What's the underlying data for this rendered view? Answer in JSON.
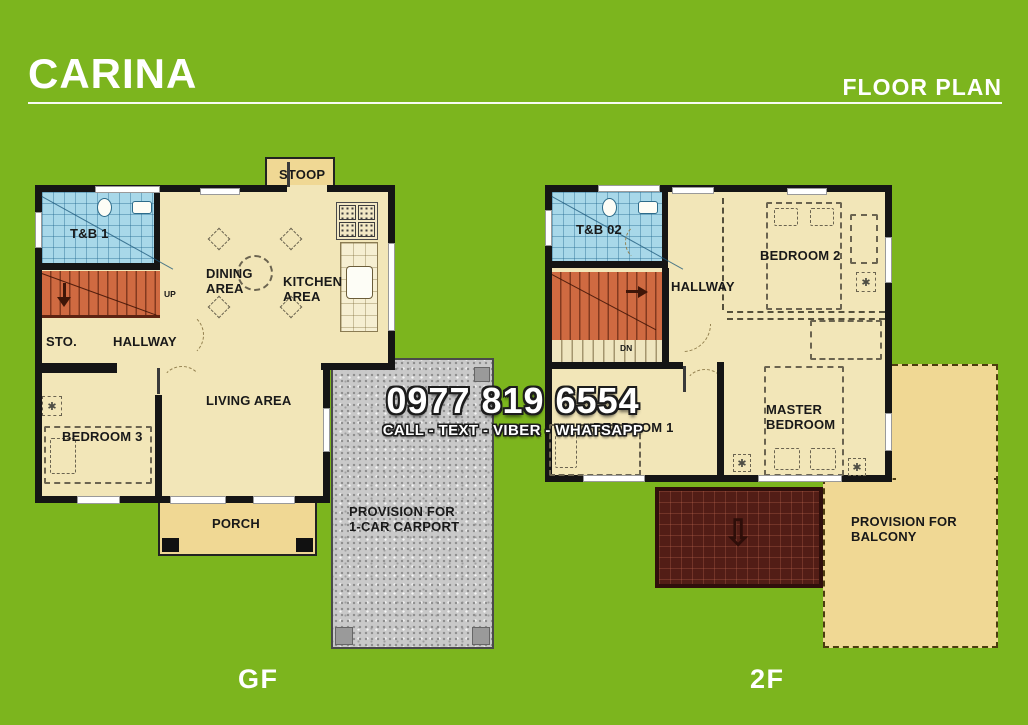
{
  "header": {
    "title": "CARINA",
    "right_title": "FLOOR PLAN"
  },
  "overlay": {
    "phone": "0977 819 6554",
    "channels": "CALL - TEXT - VIBER - WHATSAPP"
  },
  "ground_floor": {
    "floor_label": "GF",
    "rooms": {
      "stoop": "STOOP",
      "toilet_bath": "T&B 1",
      "dining": "DINING\nAREA",
      "kitchen": "KITCHEN\nAREA",
      "storage": "STO.",
      "hallway": "HALLWAY",
      "living": "LIVING AREA",
      "bedroom3": "BEDROOM 3",
      "porch": "PORCH",
      "carport": "PROVISION FOR\n1-CAR CARPORT",
      "stairs_up": "UP"
    }
  },
  "second_floor": {
    "floor_label": "2F",
    "rooms": {
      "toilet_bath": "T&B 02",
      "hallway": "HALLWAY",
      "bedroom2": "BEDROOM 2",
      "bedroom1": "BEDROOM 1",
      "master": "MASTER\nBEDROOM",
      "balcony": "PROVISION FOR\nBALCONY",
      "stairs_down": "DN"
    }
  },
  "colors": {
    "background": "#7CB51E",
    "floor": "#F2E6B8",
    "accent_cream": "#F0D894",
    "bath_blue": "#A8D8E9",
    "stair_orange": "#CF6A41",
    "roof_maroon": "#521D16",
    "wall": "#151515",
    "carport_gray": "#C9C9C9"
  }
}
